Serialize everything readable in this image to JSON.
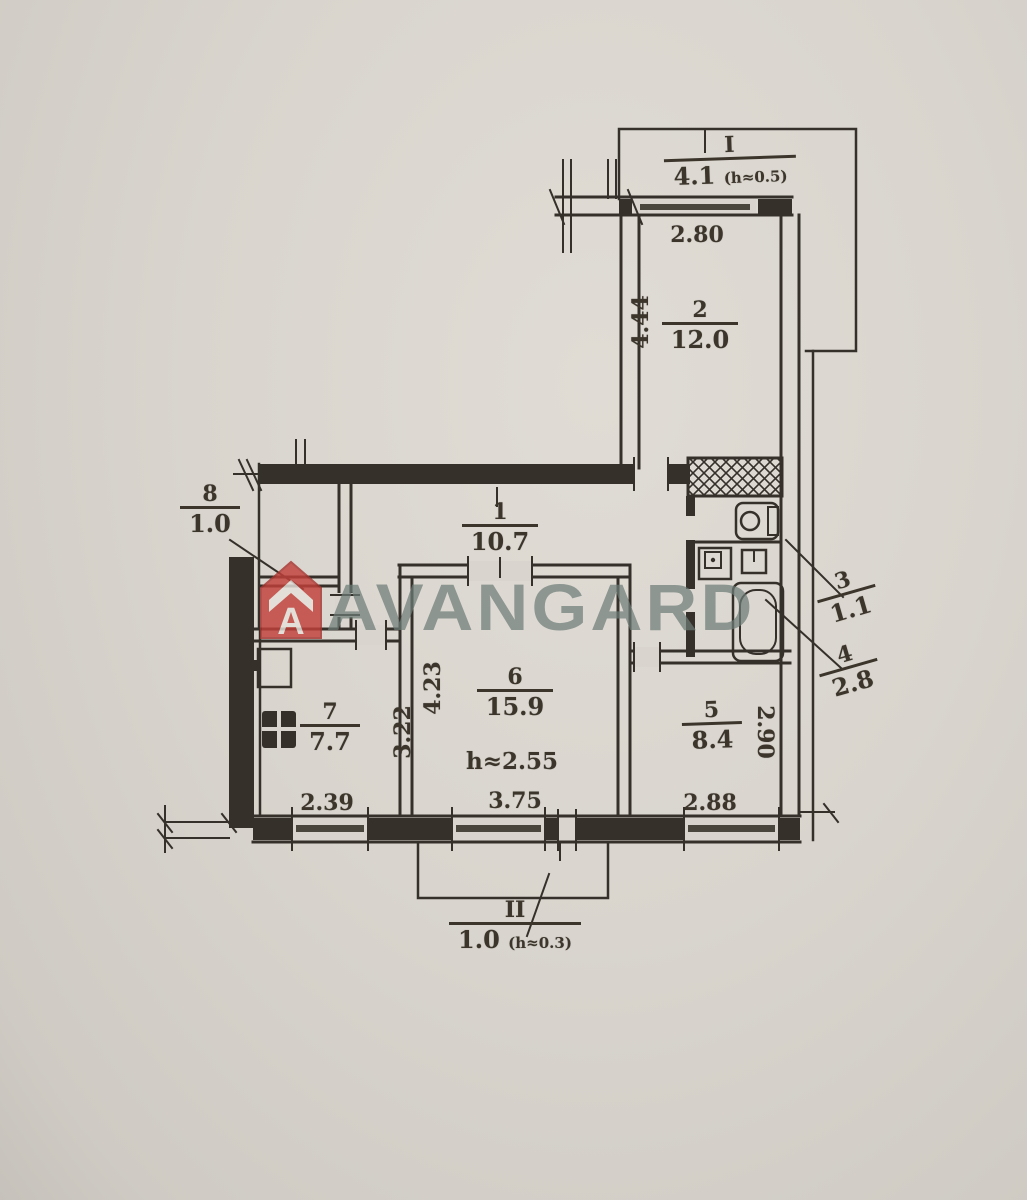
{
  "watermark": {
    "brand": "AVANGARD"
  },
  "balconies": {
    "top": {
      "num": "I",
      "area": "4.1",
      "note": "(h≈0.5)"
    },
    "bottom": {
      "num": "II",
      "area": "1.0",
      "note": "(h≈0.3)"
    }
  },
  "rooms": {
    "r1": {
      "num": "1",
      "area": "10.7"
    },
    "r2": {
      "num": "2",
      "area": "12.0"
    },
    "r3": {
      "num": "3",
      "area": "1.1"
    },
    "r4": {
      "num": "4",
      "area": "2.8"
    },
    "r5": {
      "num": "5",
      "area": "8.4"
    },
    "r6": {
      "num": "6",
      "area": "15.9",
      "ceiling": "h≈2.55"
    },
    "r7": {
      "num": "7",
      "area": "7.7"
    },
    "r8": {
      "num": "8",
      "area": "1.0"
    }
  },
  "dims": {
    "window_top": "2.80",
    "r2_depth": "4.44",
    "r7_width": "2.39",
    "r7_depth": "3.22",
    "r6_width": "3.75",
    "r6_depth": "4.23",
    "r5_width": "2.88",
    "r5_depth": "2.90"
  },
  "colors": {
    "paper": "#d9d5ce",
    "ink": "#35302a",
    "logo_red": "#c2403a",
    "watermark_gray": "#6e7c77"
  }
}
